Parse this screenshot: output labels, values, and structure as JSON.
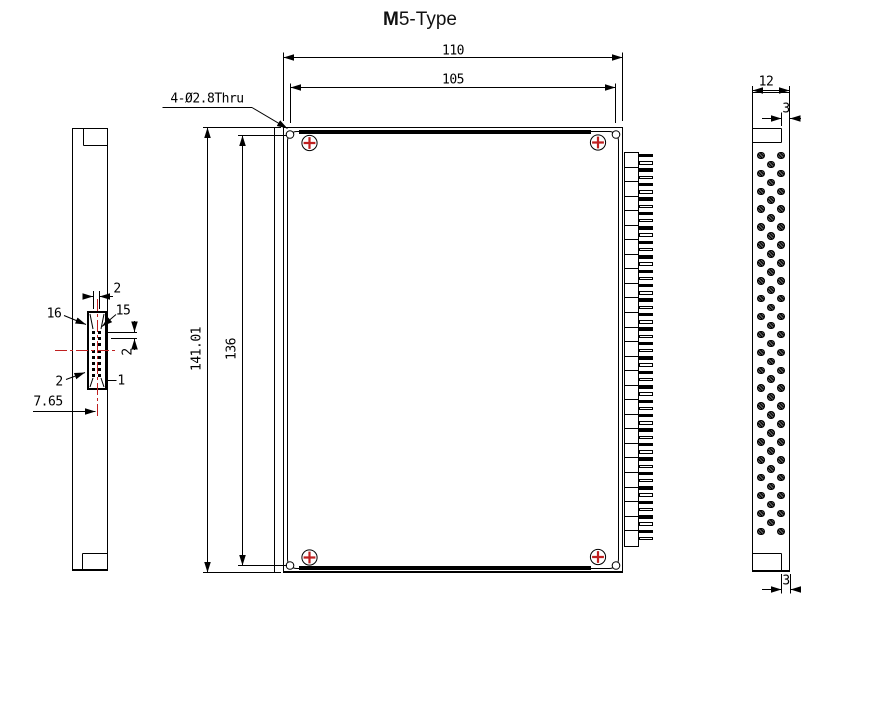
{
  "title": {
    "bold": "M",
    "rest": "5-Type"
  },
  "colors": {
    "line": "#000000",
    "red": "#bf2020"
  },
  "front_view": {
    "dim_width_outer": "110",
    "dim_width_holes": "105",
    "dim_height_outer": "141.01",
    "dim_height_rail": "136",
    "hole_callout": "4-Ø2.8Thru",
    "screw_count": 4,
    "hole_count": 4,
    "connector_segments": 27,
    "connector_fins": 54
  },
  "left_view": {
    "dim_pin_col_pitch": "2",
    "label_pin16": "16",
    "label_pin15": "15",
    "dim_pin_row_pitch": "2",
    "label_pin2": "2",
    "label_pin1": "1",
    "dim_connector_offset": "7.65",
    "pin_rows": 8,
    "pin_cols": 2
  },
  "side_view": {
    "dim_width": "12",
    "dim_top_flange": "3",
    "dim_bottom_flange": "3",
    "pin_pair_rows": 22,
    "pin_middle_rows": 21
  }
}
